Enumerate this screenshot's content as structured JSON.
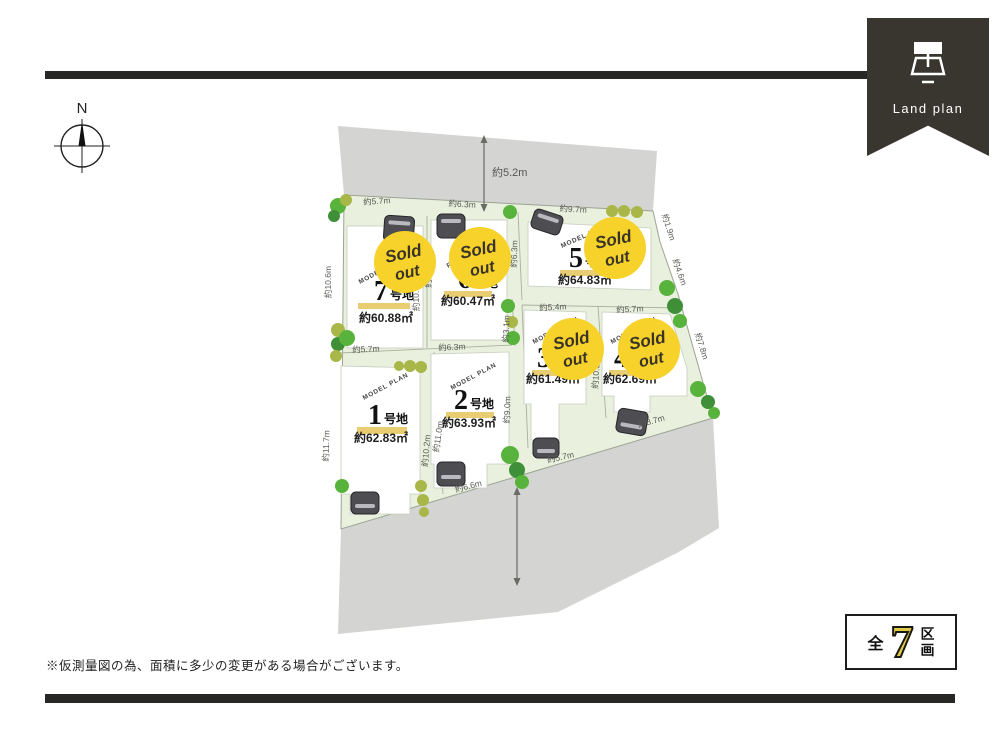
{
  "ribbon": {
    "label": "Land plan"
  },
  "compass": {
    "north_label": "N"
  },
  "map": {
    "road_dim_top": "約5.2m",
    "dims": [
      "約5.7m",
      "約6.3m",
      "約9.7m",
      "約1.9m",
      "約4.6m",
      "約7.8m",
      "約10.6m",
      "約11.7m",
      "約10.4m",
      "約9.5m",
      "約6.3m",
      "約3.1m",
      "約5.7m",
      "約6.3m",
      "約5.4m",
      "約5.7m",
      "約10.2m",
      "約11.0m",
      "約9.0m",
      "約10.3m",
      "約6.6m",
      "約5.7m",
      "約8.7m"
    ],
    "lots": [
      {
        "num": "1",
        "suffix": "号地",
        "plan": "MODEL PLAN",
        "area": "約62.83㎡",
        "sold_out": false
      },
      {
        "num": "2",
        "suffix": "号地",
        "plan": "MODEL PLAN",
        "area": "約63.93㎡",
        "sold_out": false
      },
      {
        "num": "3",
        "suffix": "号地",
        "plan": "MODEL PLAN",
        "area": "約61.49㎡",
        "sold_out": true
      },
      {
        "num": "4",
        "suffix": "号地",
        "plan": "MODEL PLAN",
        "area": "約62.69㎡",
        "sold_out": true
      },
      {
        "num": "5",
        "suffix": "号地",
        "plan": "MODEL HOUSE",
        "area": "約64.83㎡",
        "sold_out": true
      },
      {
        "num": "6",
        "suffix": "号地",
        "plan": "FREE PLAN",
        "area": "約60.47㎡",
        "sold_out": true
      },
      {
        "num": "7",
        "suffix": "号地",
        "plan": "MODEL PLAN",
        "area": "約60.88㎡",
        "sold_out": true
      }
    ],
    "sold_out_badge": {
      "line1": "Sold",
      "line2": "out"
    }
  },
  "footer": {
    "note": "※仮測量図の為、面積に多少の変更がある場合がございます。",
    "summary": {
      "prefix": "全",
      "count": "7",
      "unit_line1": "区",
      "unit_line2": "画"
    }
  },
  "colors": {
    "bar_black": "#272725",
    "ribbon_dark": "#39362f",
    "road_gray": "#d4d4d3",
    "parcel_green": "#e9f1de",
    "sold_yellow": "#f6d22b",
    "underline_tan": "#e9cd72",
    "count_yellow": "#e0ca45"
  }
}
